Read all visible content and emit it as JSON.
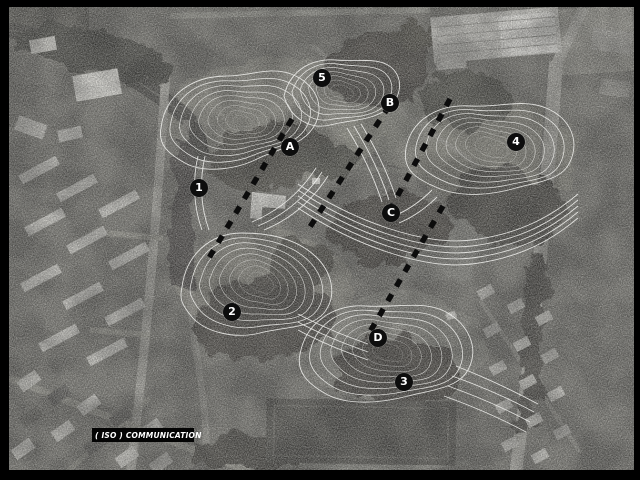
{
  "plan": {
    "kind": "aerial-photo-master-plan",
    "description": "black-and-white aerial photograph of a park with white contour-line landform overlay, dashed section lines and point markers"
  },
  "colors": {
    "frame": "#000000",
    "photo_base": "#6f6e68",
    "contour_line": "#f5f5f2",
    "section_line": "#0c0c0c",
    "marker_background": "#0d0d0d",
    "marker_text": "#ffffff",
    "title_background": "#040404",
    "title_text": "#ffffff"
  },
  "markers": [
    {
      "label": "1"
    },
    {
      "label": "2"
    },
    {
      "label": "3"
    },
    {
      "label": "4"
    },
    {
      "label": "5"
    },
    {
      "label": "A"
    },
    {
      "label": "B"
    },
    {
      "label": "C"
    },
    {
      "label": "D"
    }
  ],
  "title_block": {
    "project_name": "( ISO ) COMMUNICATION",
    "subtitle": "Project",
    "plan_name": "General_Plan"
  }
}
